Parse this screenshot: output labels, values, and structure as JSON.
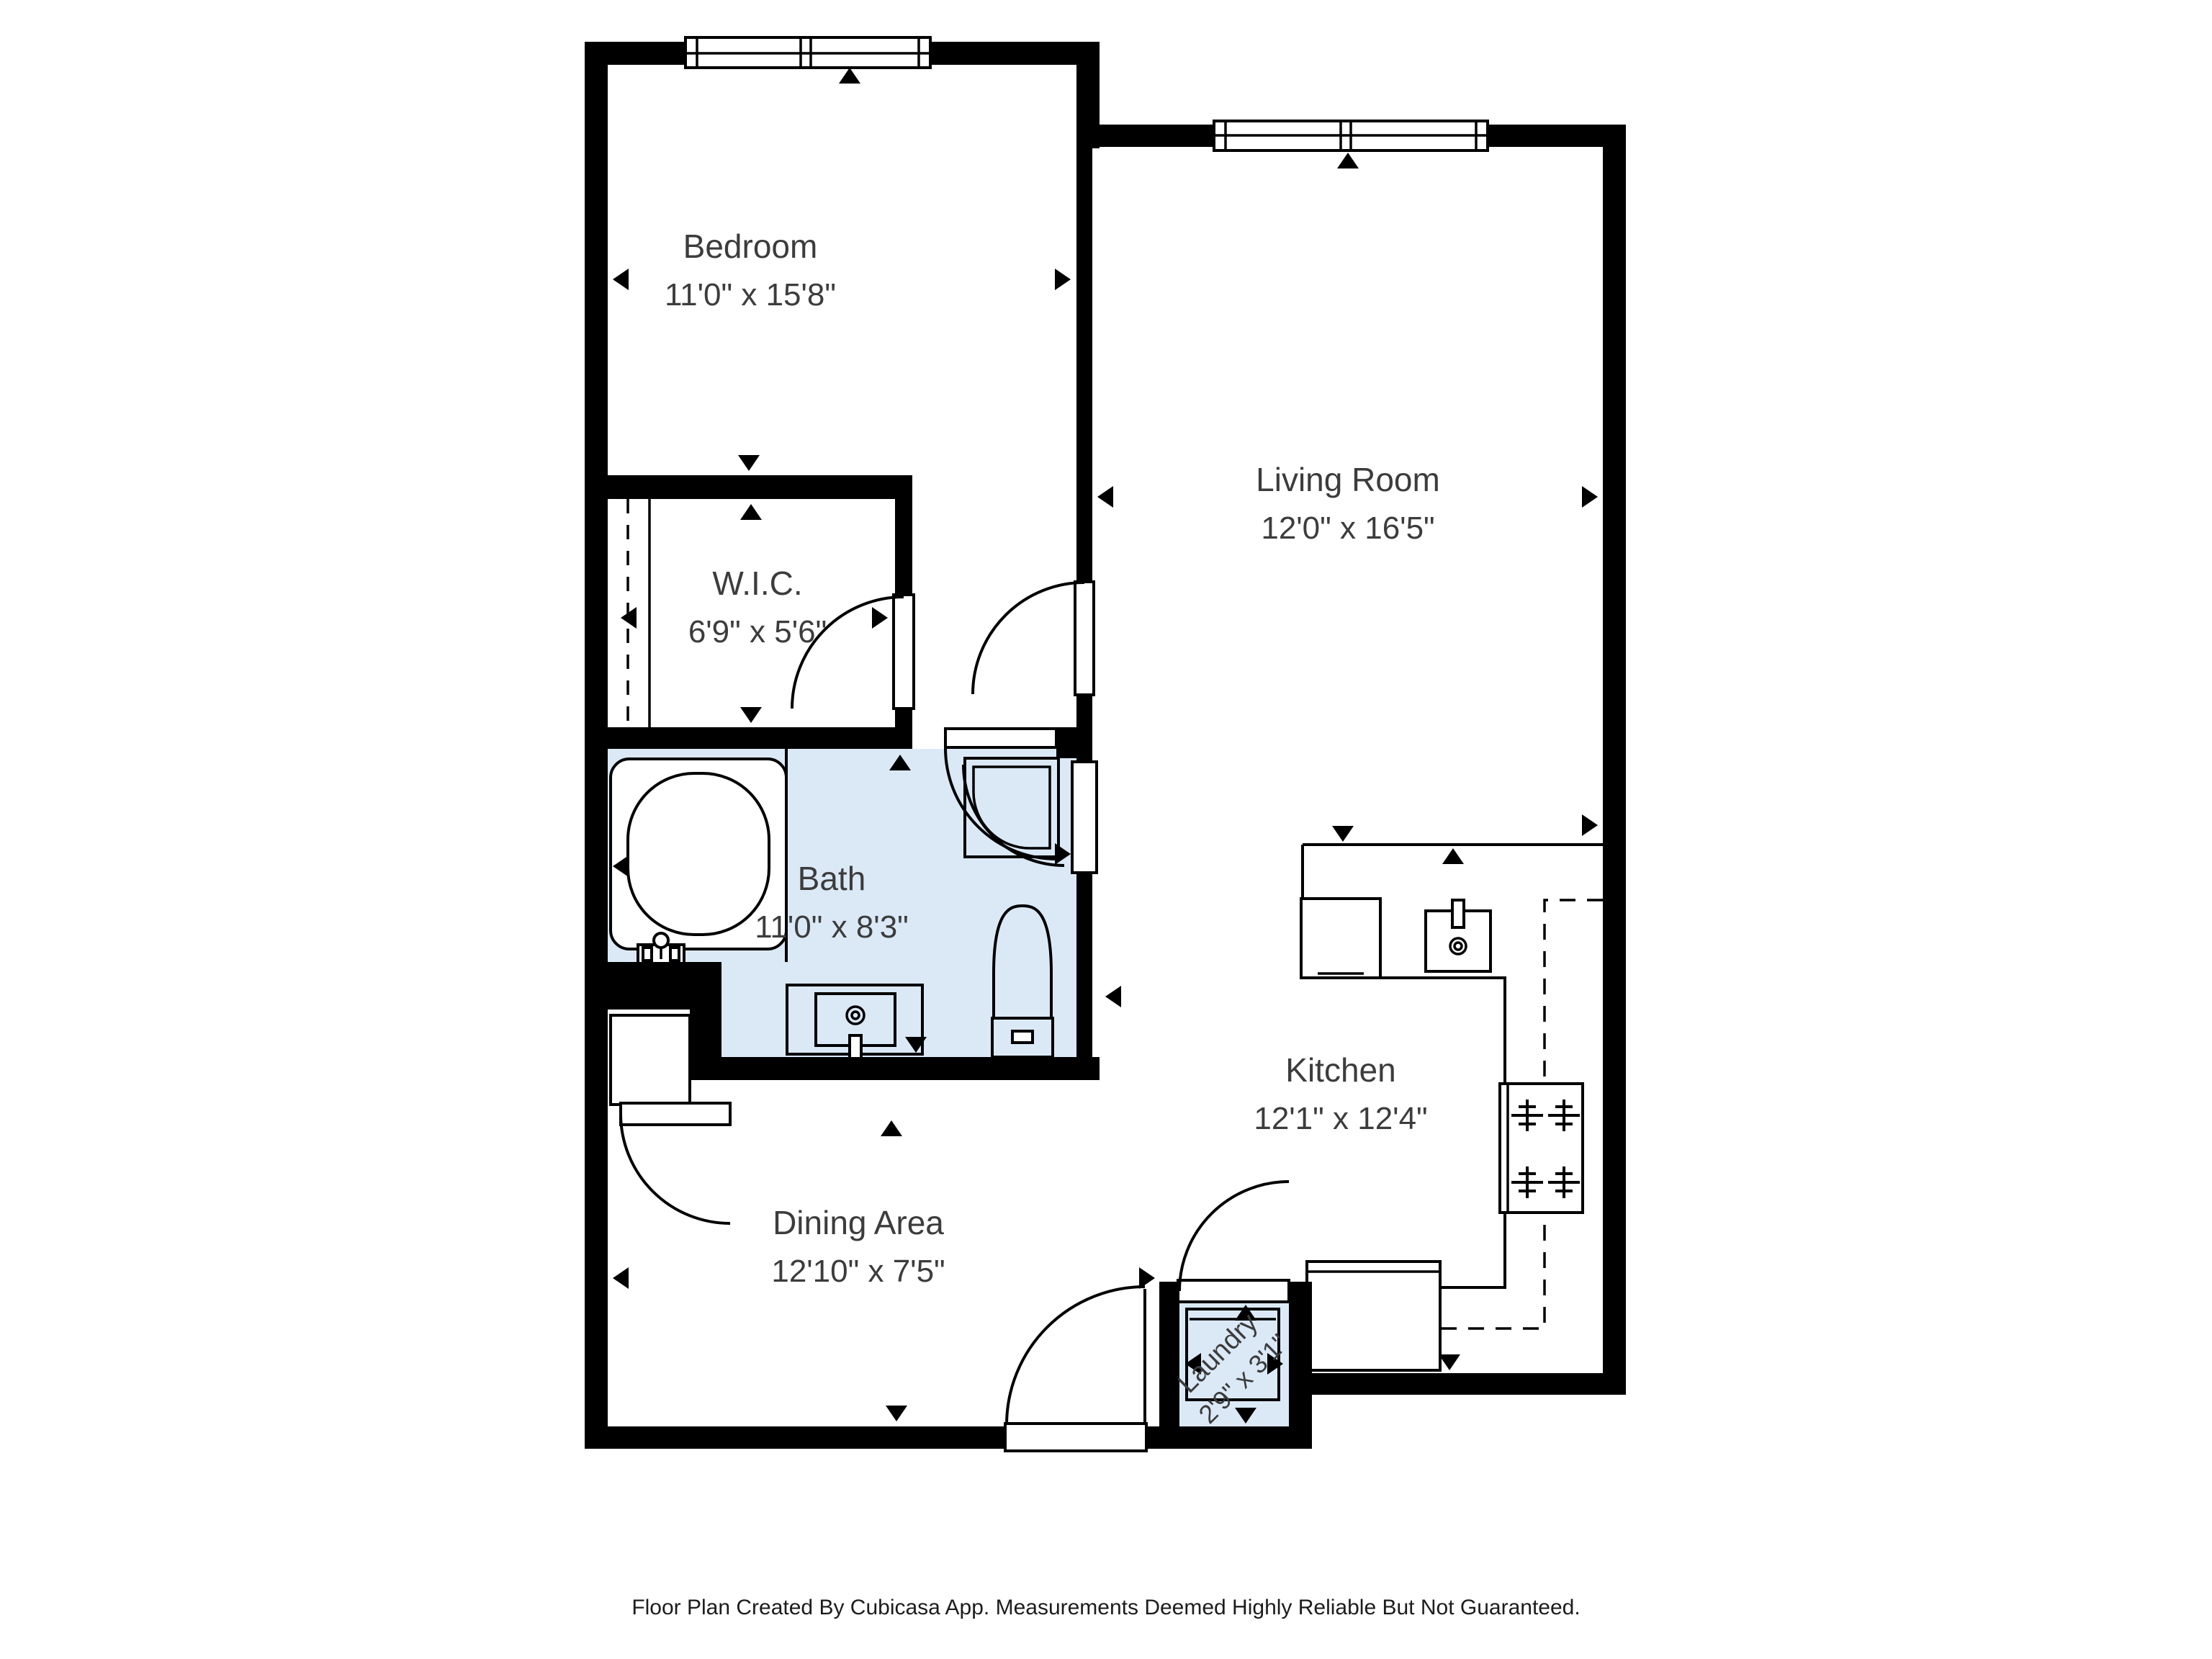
{
  "colors": {
    "wall": "#000000",
    "floor_fill": "#ffffff",
    "wet_room_fill": "#dbe9f7",
    "label": "#3c3c3c"
  },
  "rooms": [
    {
      "name": "Bedroom",
      "dimensions": "11'0\" x 15'8\""
    },
    {
      "name": "Living Room",
      "dimensions": "12'0\" x 16'5\""
    },
    {
      "name": "W.I.C.",
      "dimensions": "6'9\" x 5'6\""
    },
    {
      "name": "Bath",
      "dimensions": "11'0\" x 8'3\""
    },
    {
      "name": "Kitchen",
      "dimensions": "12'1\" x 12'4\""
    },
    {
      "name": "Dining Area",
      "dimensions": "12'10\" x 7'5\""
    },
    {
      "name": "Laundry",
      "dimensions": "2'9\" x 3'1\""
    }
  ],
  "footer": {
    "text": "Floor Plan Created By Cubicasa App. Measurements Deemed Highly Reliable But Not Guaranteed."
  }
}
